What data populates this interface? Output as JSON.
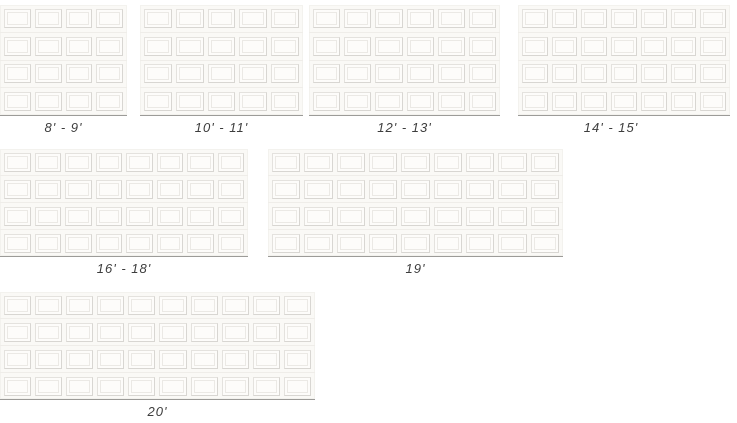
{
  "palette": {
    "door_face": "#faf9f6",
    "panel_face": "#fdfcfa",
    "panel_border": "#e4e2de",
    "panel_border_dark": "#d8d6d2",
    "panel_inner_border": "#ebe9e5",
    "section_divider": "#efede9",
    "base_line": "#9c9b98",
    "label_color": "#3d3d3d"
  },
  "doors": [
    {
      "id": "8-9",
      "label": "8' - 9'",
      "columns": 4,
      "rows": 4
    },
    {
      "id": "10-11",
      "label": "10' - 11'",
      "columns": 5,
      "rows": 4
    },
    {
      "id": "12-13",
      "label": "12' - 13'",
      "columns": 6,
      "rows": 4
    },
    {
      "id": "14-15",
      "label": "14' - 15'",
      "columns": 7,
      "rows": 4
    },
    {
      "id": "16-18",
      "label": "16' - 18'",
      "columns": 8,
      "rows": 4
    },
    {
      "id": "19",
      "label": "19'",
      "columns": 9,
      "rows": 4
    },
    {
      "id": "20",
      "label": "20'",
      "columns": 10,
      "rows": 4
    }
  ]
}
